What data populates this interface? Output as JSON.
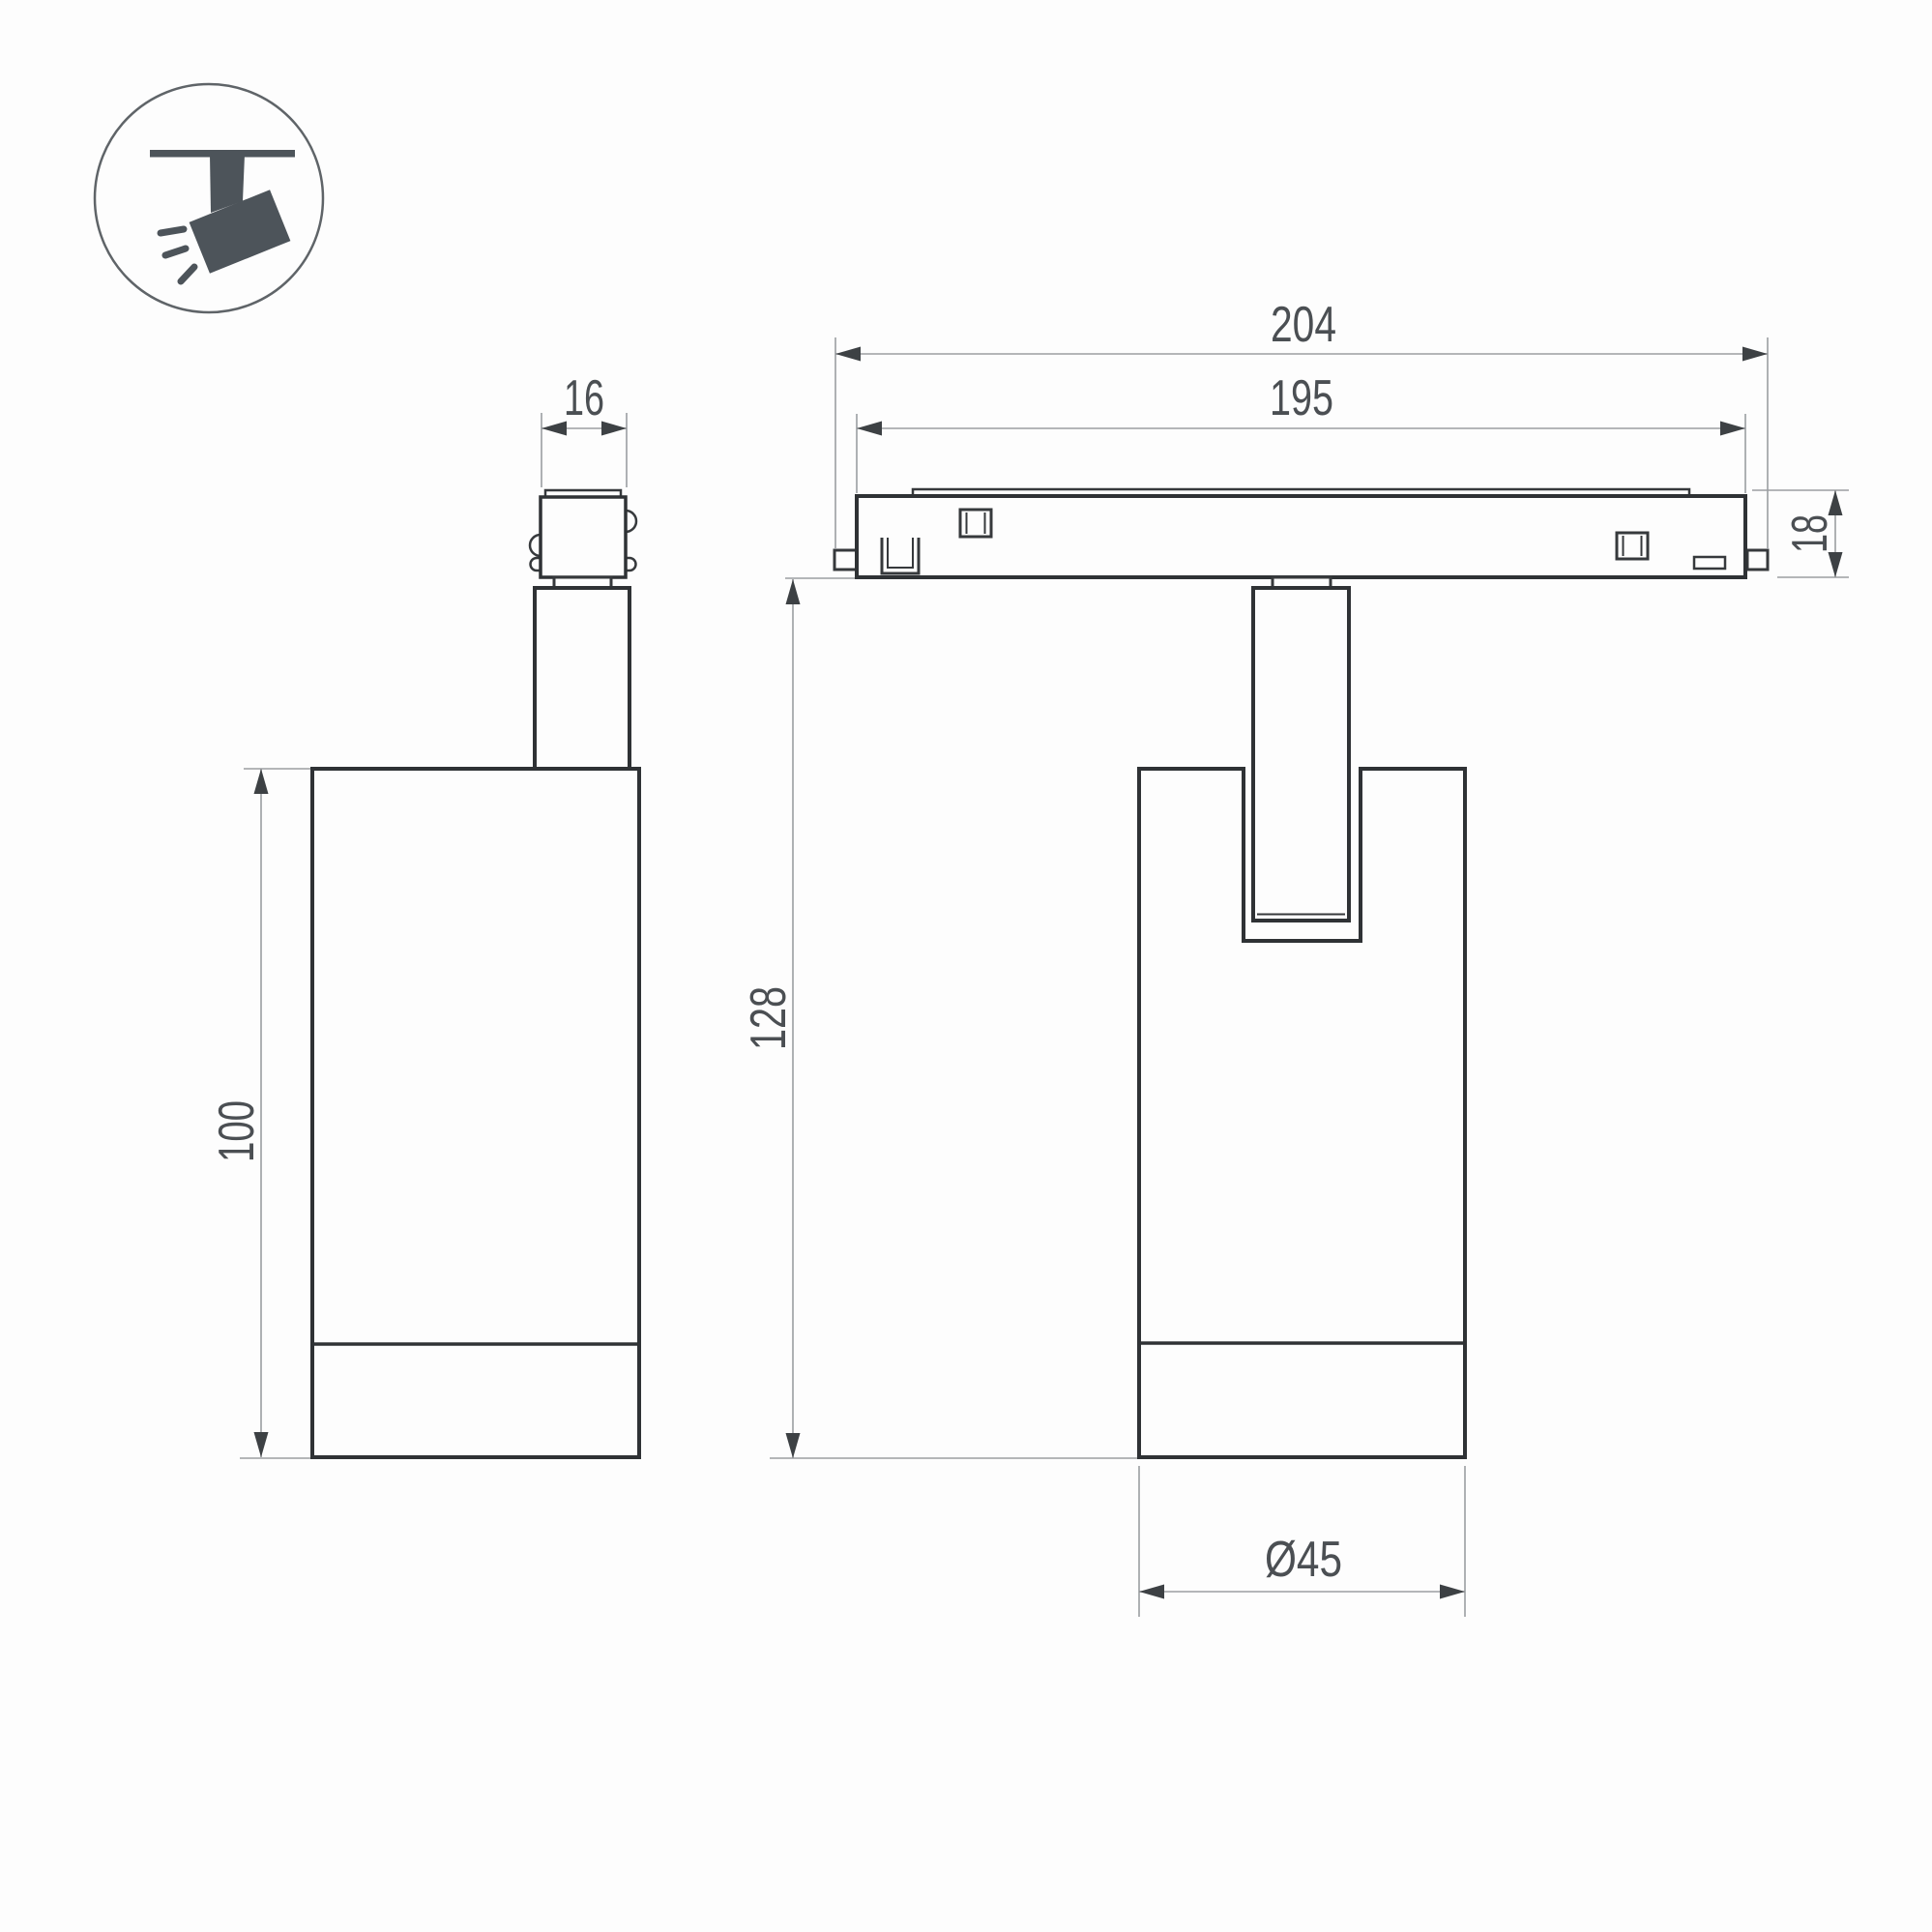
{
  "drawing": {
    "type": "technical-dimension-drawing",
    "subject": "track-mounted spotlight with magnetic track adapter",
    "colors": {
      "background": "#fdfdfd",
      "outline": "#2f3235",
      "detail": "#36393c",
      "thin": "#9b9ea1",
      "arrow": "#3d4144",
      "text": "#4b4f53",
      "icon": "#4d545a",
      "icon_circle": "#5f6468"
    },
    "icon": {
      "name": "ceiling-track-spotlight-pictogram"
    },
    "side_view": {
      "adapter_width": "16",
      "body_height": "100"
    },
    "front_view": {
      "track_overall_length": "204",
      "track_length": "195",
      "track_height": "18",
      "fixture_height": "128",
      "body_diameter": "Ø45"
    }
  }
}
